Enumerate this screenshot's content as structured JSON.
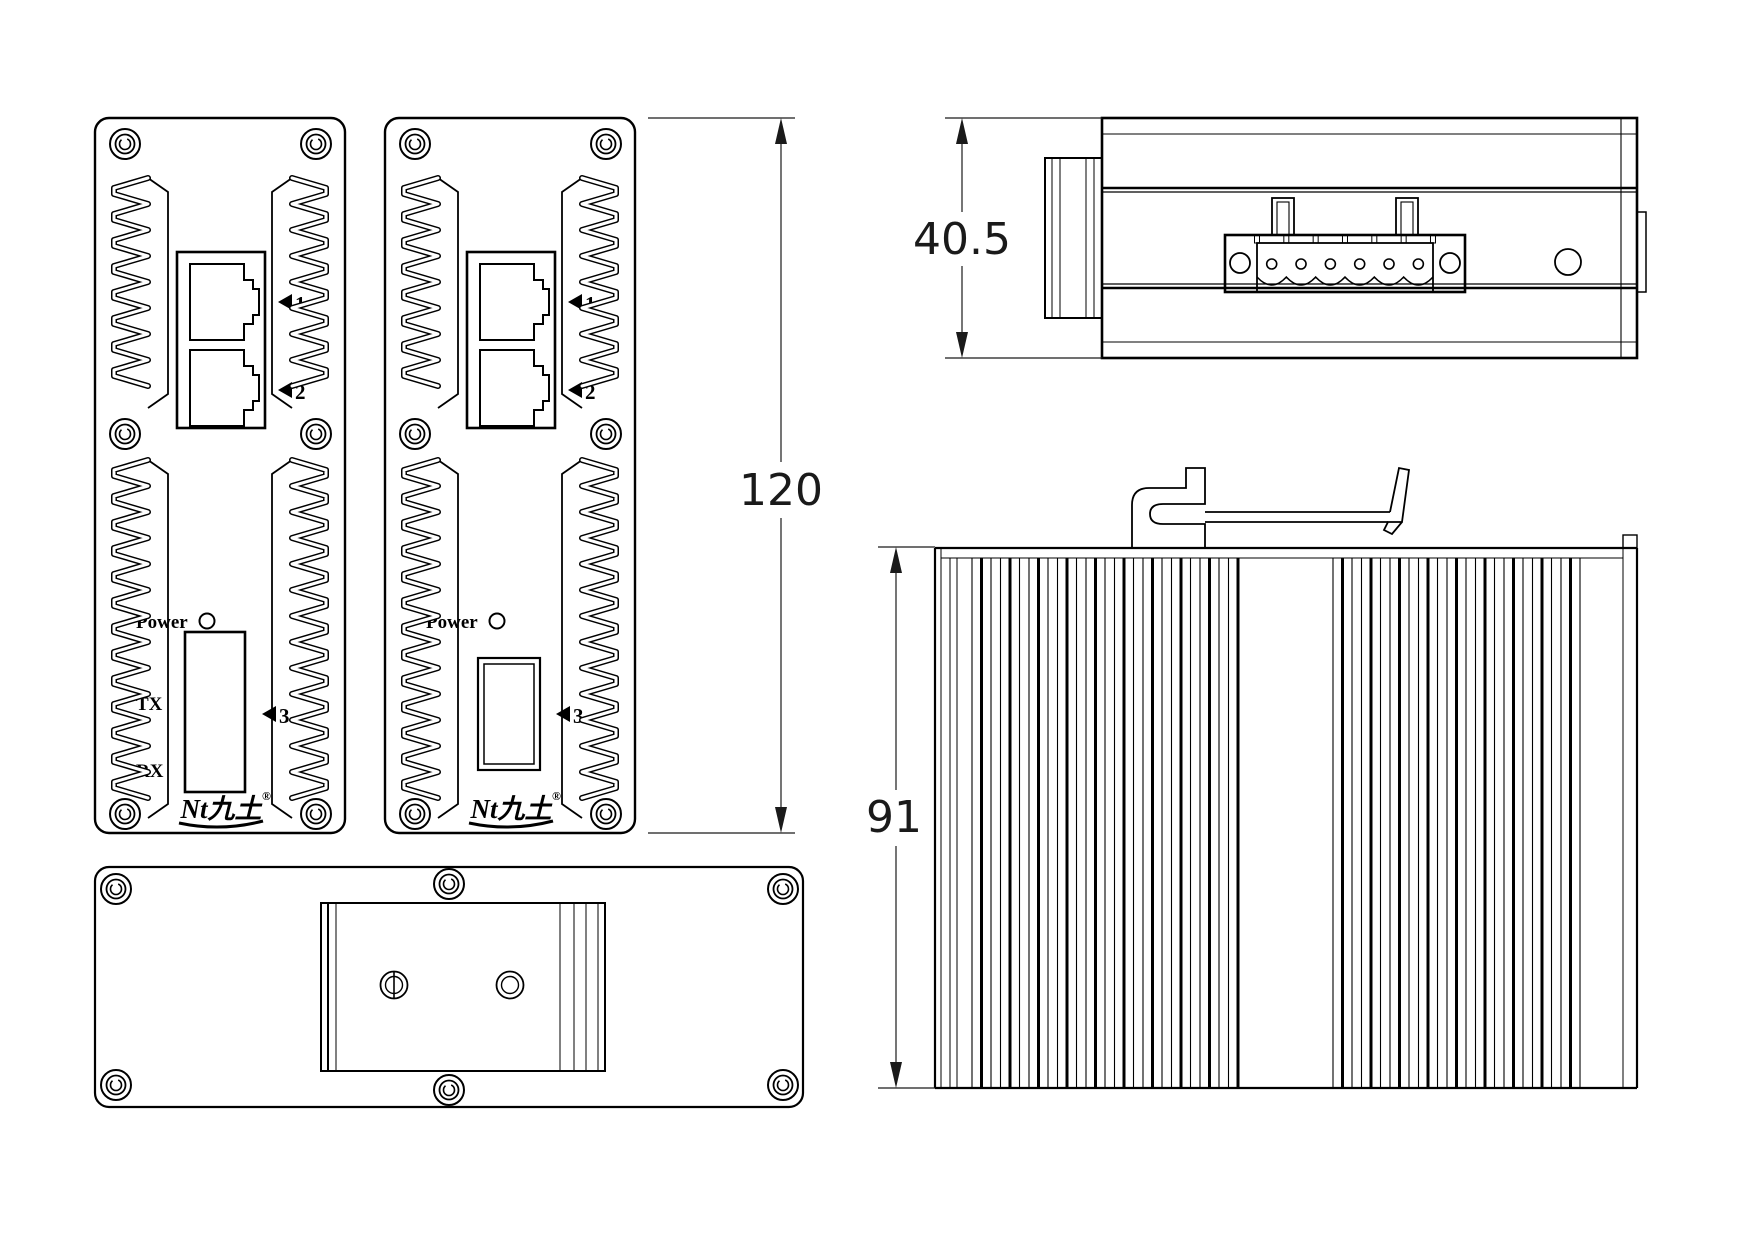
{
  "drawing": {
    "background": "#ffffff",
    "line_color": "#000000",
    "type": "engineering-drawing",
    "subject": "industrial media converter enclosure, four orthographic views"
  },
  "dims": {
    "front_height": "120",
    "top_width": "40.5",
    "side_height": "91"
  },
  "labels": {
    "power": "Power",
    "tx": "TX",
    "rx": "RX",
    "port1": "1",
    "port2": "2",
    "port3": "3"
  },
  "logo": {
    "text": "Nt九土",
    "reg": "®"
  }
}
